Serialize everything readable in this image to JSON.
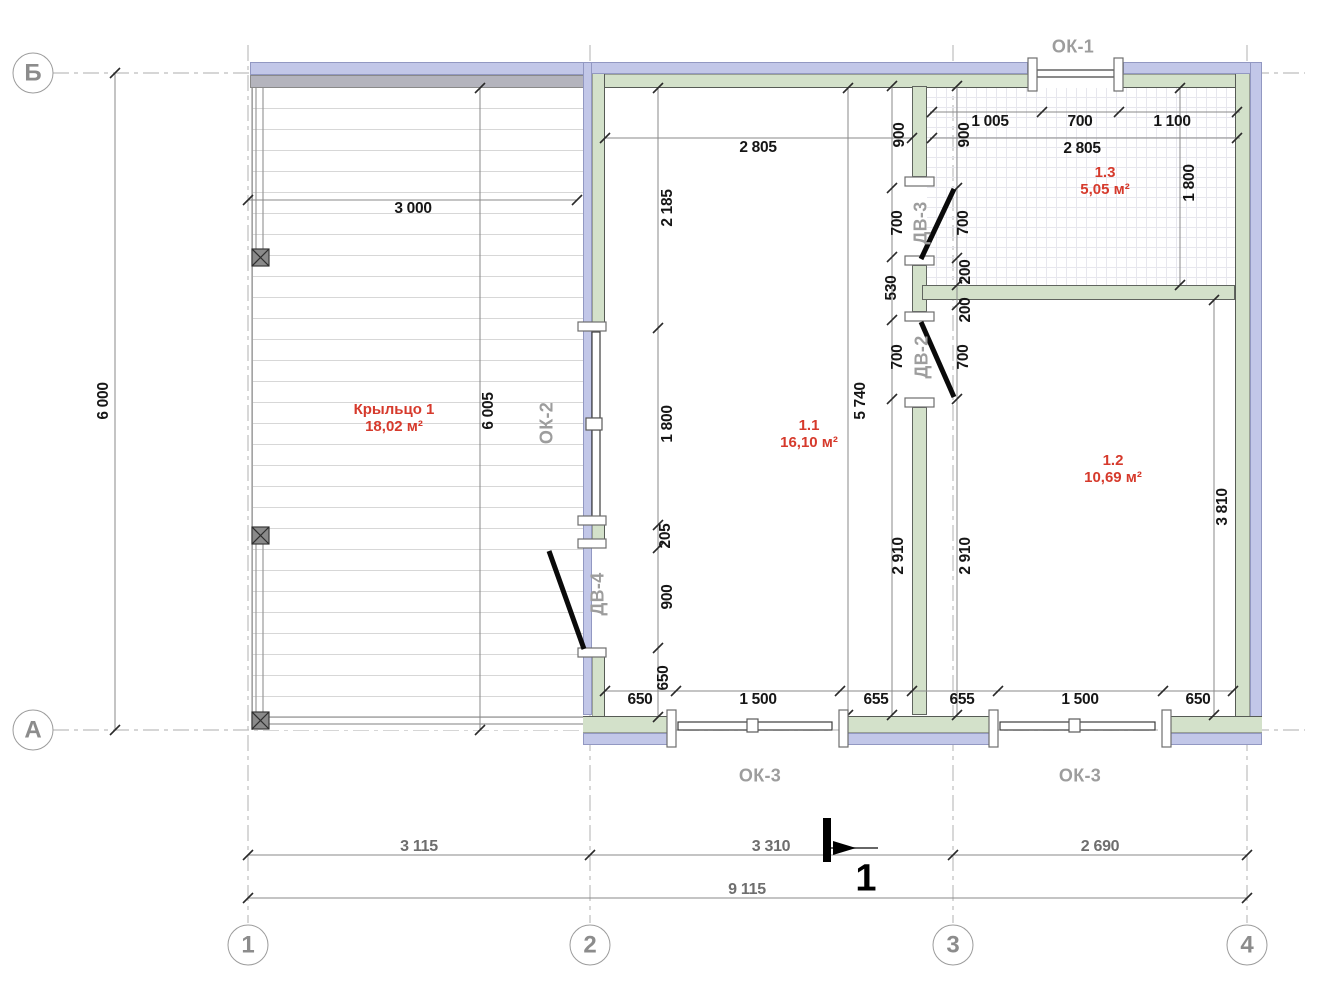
{
  "colors": {
    "insulation_band": "#c2c7e8",
    "frame_band": "#d3e1ca",
    "porch_wall": "#b4b4bd",
    "room_label": "#d63a2c",
    "tag_label": "#9d9d9d",
    "dimension_text": "#161616",
    "grid_text": "#8c8c8c"
  },
  "grid_bubbles": [
    {
      "label": "Б",
      "x": 33,
      "y": 73
    },
    {
      "label": "А",
      "x": 33,
      "y": 730
    },
    {
      "label": "1",
      "x": 248,
      "y": 945
    },
    {
      "label": "2",
      "x": 590,
      "y": 945
    },
    {
      "label": "3",
      "x": 953,
      "y": 945
    },
    {
      "label": "4",
      "x": 1247,
      "y": 945
    }
  ],
  "rooms": [
    {
      "number": "1.1",
      "area": "16,10 м²",
      "x": 809,
      "y": 434
    },
    {
      "number": "1.2",
      "area": "10,69 м²",
      "x": 1113,
      "y": 469
    },
    {
      "number": "1.3",
      "area": "5,05 м²",
      "x": 1105,
      "y": 181
    },
    {
      "number": "Крыльцо 1",
      "area": "18,02 м²",
      "x": 394,
      "y": 418
    }
  ],
  "tags": [
    {
      "text": "ОК-1",
      "x": 1073,
      "y": 47,
      "rot": 0
    },
    {
      "text": "ОК-2",
      "x": 547,
      "y": 423,
      "rot": 1
    },
    {
      "text": "ОК-3",
      "x": 760,
      "y": 776,
      "rot": 0
    },
    {
      "text": "ОК-3",
      "x": 1080,
      "y": 776,
      "rot": 0
    },
    {
      "text": "ДВ-3",
      "x": 921,
      "y": 223,
      "rot": 1
    },
    {
      "text": "ДВ-2",
      "x": 922,
      "y": 357,
      "rot": 1
    },
    {
      "text": "ДВ-4",
      "x": 598,
      "y": 594,
      "rot": 1
    }
  ],
  "dims": [
    {
      "text": "3 000",
      "x": 413,
      "y": 209,
      "rot": 0
    },
    {
      "text": "2 805",
      "x": 758,
      "y": 148,
      "rot": 0
    },
    {
      "text": "1 005",
      "x": 990,
      "y": 122,
      "rot": 0
    },
    {
      "text": "700",
      "x": 1080,
      "y": 122,
      "rot": 0
    },
    {
      "text": "1 100",
      "x": 1172,
      "y": 122,
      "rot": 0
    },
    {
      "text": "2 805",
      "x": 1082,
      "y": 149,
      "rot": 0
    },
    {
      "text": "650",
      "x": 640,
      "y": 700,
      "rot": 0
    },
    {
      "text": "1 500",
      "x": 758,
      "y": 700,
      "rot": 0
    },
    {
      "text": "655",
      "x": 876,
      "y": 700,
      "rot": 0
    },
    {
      "text": "655",
      "x": 962,
      "y": 700,
      "rot": 0
    },
    {
      "text": "1 500",
      "x": 1080,
      "y": 700,
      "rot": 0
    },
    {
      "text": "650",
      "x": 1198,
      "y": 700,
      "rot": 0
    },
    {
      "text": "3 115",
      "x": 419,
      "y": 847,
      "rot": 0,
      "muted": true
    },
    {
      "text": "3 310",
      "x": 771,
      "y": 847,
      "rot": 0,
      "muted": true
    },
    {
      "text": "2 690",
      "x": 1100,
      "y": 847,
      "rot": 0,
      "muted": true
    },
    {
      "text": "9 115",
      "x": 747,
      "y": 890,
      "rot": 0,
      "muted": true
    },
    {
      "text": "6 000",
      "x": 104,
      "y": 401,
      "rot": 1
    },
    {
      "text": "6 005",
      "x": 489,
      "y": 411,
      "rot": 1
    },
    {
      "text": "2 185",
      "x": 668,
      "y": 208,
      "rot": 1
    },
    {
      "text": "1 800",
      "x": 668,
      "y": 424,
      "rot": 1
    },
    {
      "text": "205",
      "x": 666,
      "y": 536,
      "rot": 1
    },
    {
      "text": "900",
      "x": 668,
      "y": 597,
      "rot": 1
    },
    {
      "text": "650",
      "x": 664,
      "y": 678,
      "rot": 1
    },
    {
      "text": "5 740",
      "x": 861,
      "y": 401,
      "rot": 1
    },
    {
      "text": "900",
      "x": 900,
      "y": 135,
      "rot": 1
    },
    {
      "text": "700",
      "x": 898,
      "y": 223,
      "rot": 1
    },
    {
      "text": "530",
      "x": 892,
      "y": 288,
      "rot": 1
    },
    {
      "text": "700",
      "x": 898,
      "y": 357,
      "rot": 1
    },
    {
      "text": "2 910",
      "x": 899,
      "y": 556,
      "rot": 1
    },
    {
      "text": "900",
      "x": 965,
      "y": 135,
      "rot": 1
    },
    {
      "text": "700",
      "x": 964,
      "y": 223,
      "rot": 1
    },
    {
      "text": "200",
      "x": 966,
      "y": 272,
      "rot": 1
    },
    {
      "text": "200",
      "x": 966,
      "y": 310,
      "rot": 1
    },
    {
      "text": "700",
      "x": 964,
      "y": 357,
      "rot": 1
    },
    {
      "text": "2 910",
      "x": 966,
      "y": 556,
      "rot": 1
    },
    {
      "text": "1 800",
      "x": 1190,
      "y": 183,
      "rot": 1
    },
    {
      "text": "3 810",
      "x": 1223,
      "y": 507,
      "rot": 1
    }
  ],
  "section": {
    "label": "1",
    "x": 866,
    "y": 879
  }
}
